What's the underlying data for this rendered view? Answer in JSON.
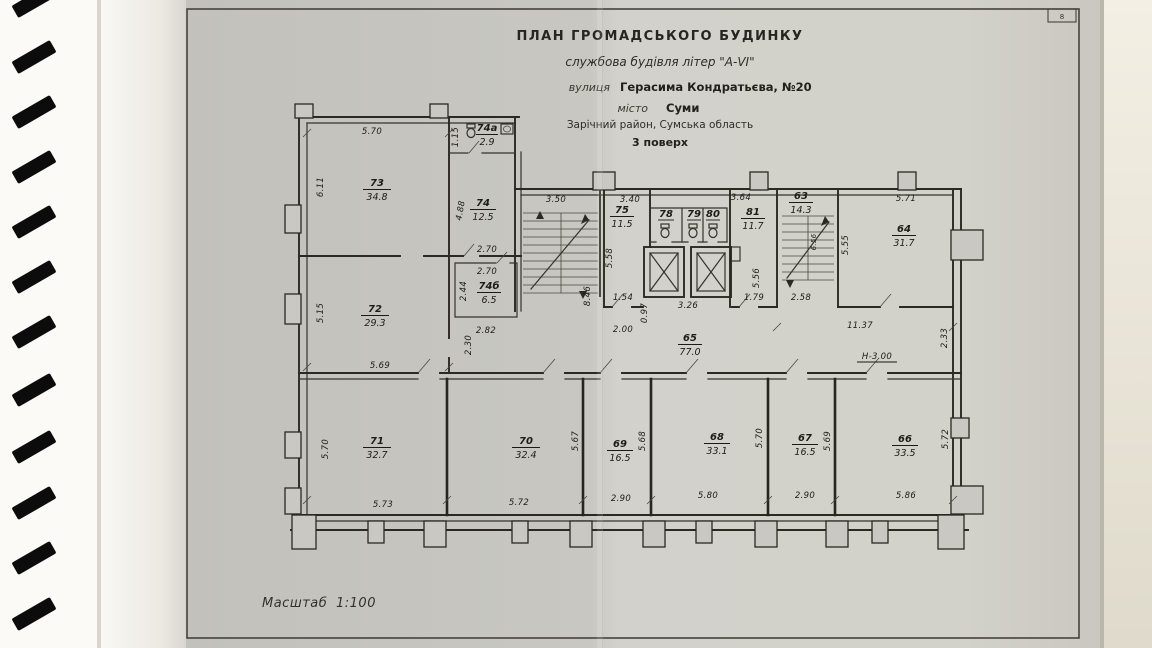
{
  "photo": {
    "corner_mark": "8"
  },
  "title_block": {
    "line1": "ПЛАН  ГРОМАДСЬКОГО  БУДИНКУ",
    "line2": "службова будівля літер \"А-VI\"",
    "line3_label": "вулиця",
    "line3_value": "Герасима Кондратьєва, №20",
    "line4_label": "місто",
    "line4_value": "Суми",
    "line5": "Зарічний район, Сумська область",
    "line6": "3 поверх"
  },
  "scale": {
    "label": "Масштаб",
    "value": "1:100"
  },
  "rooms": {
    "r63": {
      "num": "63",
      "area": "14.3"
    },
    "r64": {
      "num": "64",
      "area": "31.7"
    },
    "r65": {
      "num": "65",
      "area": "77.0"
    },
    "r66": {
      "num": "66",
      "area": "33.5"
    },
    "r67": {
      "num": "67",
      "area": "16.5"
    },
    "r68": {
      "num": "68",
      "area": "33.1"
    },
    "r69": {
      "num": "69",
      "area": "16.5"
    },
    "r70": {
      "num": "70",
      "area": "32.4"
    },
    "r71": {
      "num": "71",
      "area": "32.7"
    },
    "r72": {
      "num": "72",
      "area": "29.3"
    },
    "r73": {
      "num": "73",
      "area": "34.8"
    },
    "r74": {
      "num": "74",
      "area": "12.5"
    },
    "r74a": {
      "num": "74а",
      "area": "2.9"
    },
    "r74b": {
      "num": "74б",
      "area": "6.5"
    },
    "r75": {
      "num": "75",
      "area": "11.5"
    },
    "r78": {
      "num": "78"
    },
    "r79": {
      "num": "79"
    },
    "r80": {
      "num": "80"
    },
    "r81": {
      "num": "81",
      "area": "11.7"
    }
  },
  "dims": {
    "d73_top": "5.70",
    "d73_left": "6.11",
    "d72_left": "5.15",
    "d74a_left": "1.15",
    "d74_left": "4.88",
    "d74b_top1": "2.70",
    "d74b_top2": "2.70",
    "d74b_left": "2.44",
    "d74b_bottom": "2.82",
    "d74b_below": "2.30",
    "dstair1_top": "3.50",
    "dstair1_right": "8.46",
    "d75_top": "3.40",
    "d75_left": "5.58",
    "d75_bottom": "1.54",
    "d75_below": "2.00",
    "delev_left": "0.97",
    "delev_bottom": "3.26",
    "d81_top": "3.64",
    "d81_right": "5.56",
    "d81_bottom": "1.79",
    "dstair2_inner": "6.56",
    "dstair2_bottom": "2.58",
    "d64_left": "5.55",
    "d64_top": "5.71",
    "dright_side": "2.33",
    "dright_bottom": "11.37",
    "dheight": "Н-3.00",
    "d71_top": "5.69",
    "d71_left": "5.70",
    "d71_bottom": "5.73",
    "d70_bottom": "5.72",
    "d70_right": "5.67",
    "d69_right": "5.68",
    "d69_bottom": "2.90",
    "d68_bottom": "5.80",
    "d68_right": "5.70",
    "d67_right": "5.69",
    "d67_bottom": "2.90",
    "d66_bottom": "5.86",
    "d66_right": "5.72"
  }
}
